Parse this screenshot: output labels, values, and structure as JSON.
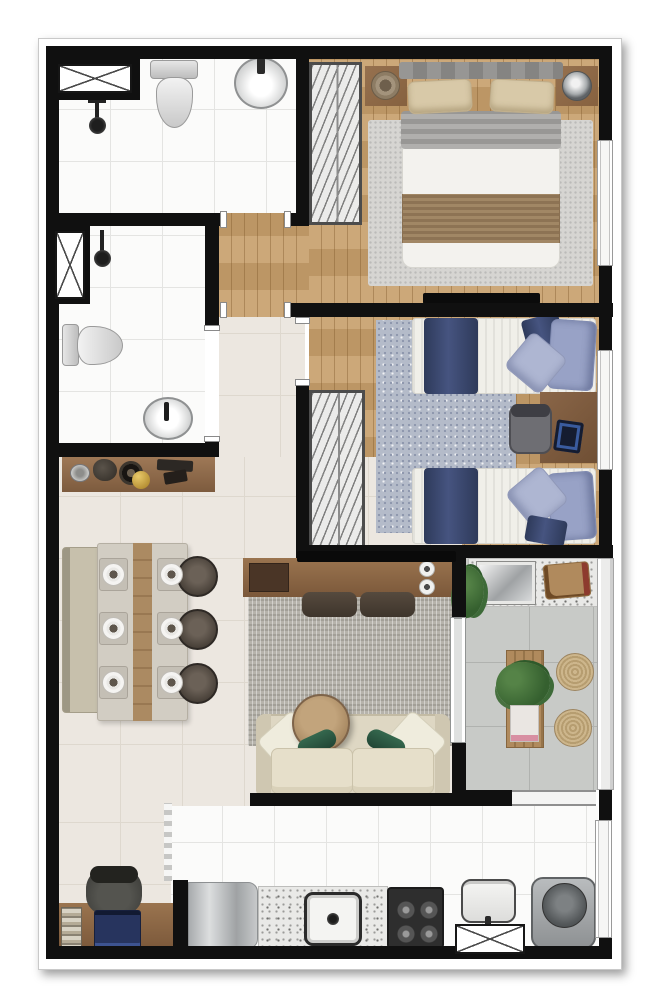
{
  "scene": {
    "type": "apartment-floor-plan-top-down-render",
    "visible_text": "",
    "rooms": [
      {
        "id": "bathroom-1",
        "items": [
          "ventilation-window",
          "shower-head",
          "toilet",
          "round-washbasin"
        ]
      },
      {
        "id": "bedroom-1",
        "items": [
          "wardrobe",
          "double-bed",
          "nightstand-left",
          "nightstand-right",
          "table-lamp",
          "rug",
          "wall-tv",
          "window"
        ]
      },
      {
        "id": "bathroom-2",
        "items": [
          "ventilation-window",
          "shower-head",
          "toilet",
          "oval-washbasin"
        ]
      },
      {
        "id": "bedroom-2",
        "items": [
          "wardrobe",
          "single-bed-top",
          "single-bed-bottom",
          "desk",
          "desk-chair",
          "tablet",
          "rug",
          "window"
        ]
      },
      {
        "id": "hall",
        "items": [
          "sideboard",
          "decor-objects"
        ]
      },
      {
        "id": "dining-area",
        "items": [
          "bench",
          "dining-table",
          "place-settings-x6",
          "chairs-x3"
        ]
      },
      {
        "id": "living-area",
        "items": [
          "tv-console",
          "tv",
          "ottomans-x2",
          "rug",
          "round-coffee-table",
          "sofa",
          "green-cushions-x2"
        ]
      },
      {
        "id": "balcony",
        "items": [
          "grill-counter-with-sink",
          "cutting-board",
          "plants-x2",
          "slat-table",
          "magazine",
          "woven-poufs-x2",
          "glass-railing",
          "sliding-door"
        ]
      },
      {
        "id": "kitchen-laundry",
        "items": [
          "refrigerator",
          "counter-with-sink",
          "cooktop",
          "laundry-tub",
          "laundry-window",
          "washing-machine",
          "side-window"
        ]
      },
      {
        "id": "home-office-nook",
        "items": [
          "desk",
          "office-chair",
          "laptop",
          "books"
        ]
      }
    ]
  },
  "palette": {
    "wall": "#101010",
    "wood_floor": "#c69e6a",
    "tile_white": "#fbfbfa",
    "tile_cream": "#ece7e0",
    "balcony_tile": "#c8cac7",
    "rug_bedroom1": "#d6d5d2",
    "rug_bedroom2": "#b4bbc9",
    "rug_living": "#b6b3ab",
    "sofa_beige": "#ded7c3",
    "cushion_green": "#2c5c43",
    "bed_navy": "#3c4a6e",
    "pillow_blue": "#9aa5c8",
    "pillow_beige": "#d8c9a8",
    "headboard_gray": "#8e8d8b",
    "runner_woven": "#9b8162",
    "furniture_wood": "#8f6b4d",
    "furniture_wood_light": "#ab8a62",
    "bench_beige": "#c7c0ac",
    "chair_dark": "#4a423a",
    "granite": "#e9e9e7",
    "appliance_metal": "#b9bcbe",
    "pouf_brown": "#4c4238",
    "pouf_tan": "#c9b287",
    "plant_green": "#3e6b3e"
  }
}
